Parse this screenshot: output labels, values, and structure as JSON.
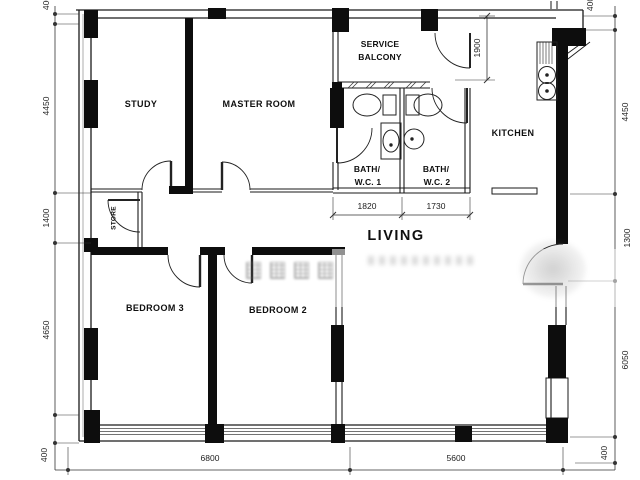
{
  "plan": {
    "rooms": {
      "study": "STUDY",
      "master_room": "MASTER ROOM",
      "service_balcony": [
        "SERVICE",
        "BALCONY"
      ],
      "bath_wc_1": [
        "BATH/",
        "W.C.  1"
      ],
      "bath_wc_2": [
        "BATH/",
        "W.C.  2"
      ],
      "kitchen": "KITCHEN",
      "store": "STORE",
      "bedroom_3": "BEDROOM 3",
      "bedroom_2": "BEDROOM 2",
      "living": "LIVING"
    },
    "dimensions": {
      "left": [
        "400",
        "4450",
        "1400",
        "4650",
        "400"
      ],
      "right": [
        "400",
        "4450",
        "1300",
        "6050",
        "400"
      ],
      "bottom": [
        "6800",
        "5600"
      ],
      "bath_widths": [
        "1820",
        "1730"
      ],
      "balcony_depth": "1900"
    }
  }
}
